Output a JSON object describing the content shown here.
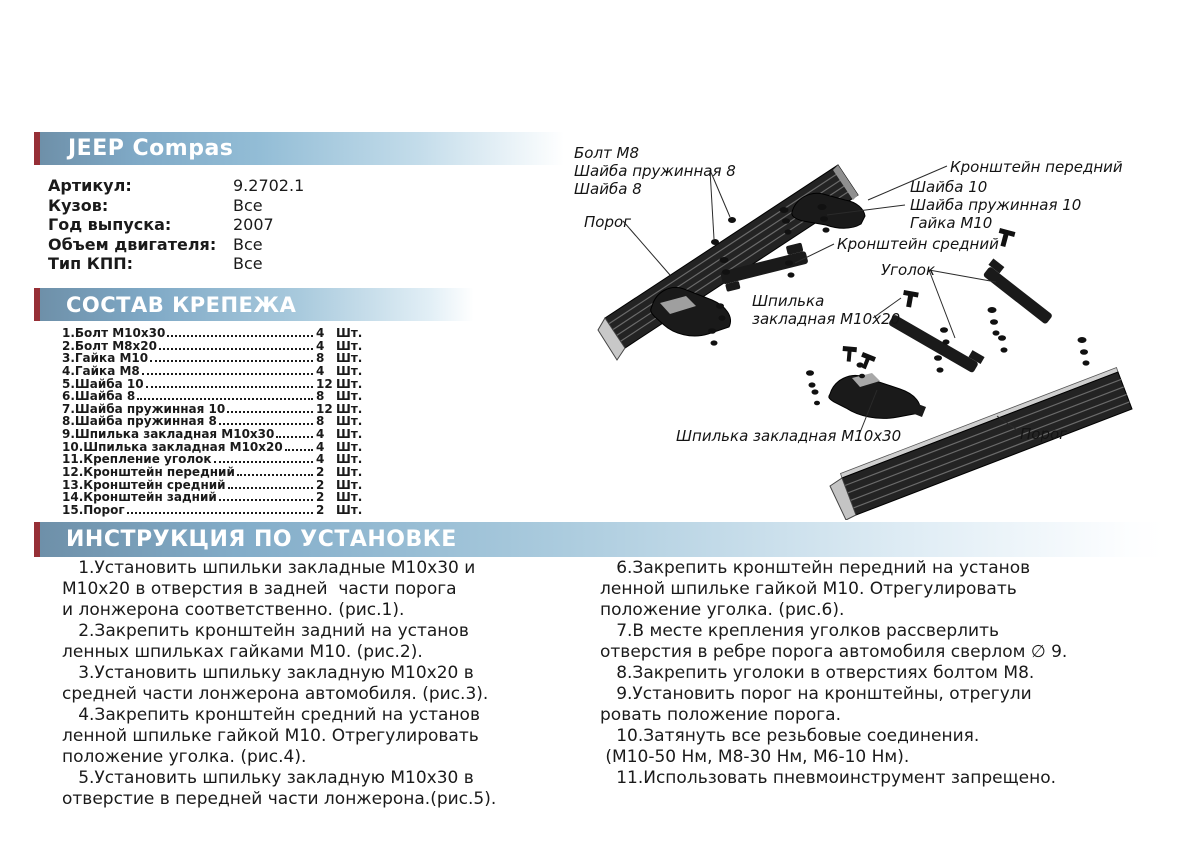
{
  "product": {
    "title": "JEEP Compas",
    "specs": [
      {
        "label": "Артикул:",
        "value": "9.2702.1"
      },
      {
        "label": "Кузов:",
        "value": "Все"
      },
      {
        "label": "Год выпуска:",
        "value": "2007"
      },
      {
        "label": "Объем двигателя:",
        "value": "Все"
      },
      {
        "label": "Тип КПП:",
        "value": "Все"
      }
    ]
  },
  "parts": {
    "header": "СОСТАВ КРЕПЕЖА",
    "unit": "Шт.",
    "items": [
      {
        "name": "1.Болт М10х30",
        "qty": "4"
      },
      {
        "name": "2.Болт М8х20",
        "qty": "4"
      },
      {
        "name": "3.Гайка М10",
        "qty": "8"
      },
      {
        "name": "4.Гайка М8",
        "qty": "4"
      },
      {
        "name": "5.Шайба 10",
        "qty": "12"
      },
      {
        "name": "6.Шайба 8",
        "qty": "8"
      },
      {
        "name": "7.Шайба пружинная 10",
        "qty": "12"
      },
      {
        "name": "8.Шайба пружинная 8",
        "qty": "8"
      },
      {
        "name": "9.Шпилька закладная М10х30",
        "qty": "4"
      },
      {
        "name": "10.Шпилька закладная М10х20",
        "qty": "4"
      },
      {
        "name": "11.Крепление уголок",
        "qty": "4"
      },
      {
        "name": "12.Кронштейн передний",
        "qty": "2"
      },
      {
        "name": "13.Кронштейн средний",
        "qty": "2"
      },
      {
        "name": "14.Кронштейн задний",
        "qty": "2"
      },
      {
        "name": "15.Порог",
        "qty": "2"
      }
    ]
  },
  "instructions": {
    "header": "ИНСТРУКЦИЯ ПО УСТАНОВКЕ",
    "left_lines": [
      "   1.Установить шпильки закладные М10х30 и",
      "М10х20 в отверстия в задней  части порога",
      "и лонжерона соответственно. (рис.1).",
      "   2.Закрепить кронштейн задний на установ",
      "ленных шпильках гайками М10. (рис.2).",
      "   3.Установить шпильку закладную М10х20 в",
      "средней части лонжерона автомобиля. (рис.3).",
      "   4.Закрепить кронштейн средний на установ",
      "ленной шпильке гайкой М10. Отрегулировать",
      "положение уголка. (рис.4).",
      "   5.Установить шпильку закладную М10х30 в",
      "отверстие в передней части лонжерона.(рис.5)."
    ],
    "right_lines": [
      "   6.Закрепить кронштейн передний на установ",
      "ленной шпильке гайкой М10. Отрегулировать",
      "положение уголка. (рис.6).",
      "   7.В месте крепления уголков рассверлить",
      "отверстия в ребре порога автомобиля сверлом ∅ 9.",
      "   8.Закрепить уголоки в отверстиях болтом М8.",
      "   9.Установить порог на кронштейны, отрегули",
      "ровать положение порога.",
      "   10.Затянуть все резьбовые соединения.",
      " (М10-50 Нм, М8-30 Нм, М6-10 Нм).",
      "   11.Использовать пневмоинструмент запрещено."
    ]
  },
  "diagram": {
    "labels": {
      "bolt_m8": "Болт М8",
      "washer_spring_8": "Шайба пружинная 8",
      "washer_8": "Шайба 8",
      "sill_left": "Порог",
      "bracket_front": "Кронштейн передний",
      "washer_10": "Шайба 10",
      "washer_spring_10": "Шайба пружинная 10",
      "nut_m10": "Гайка М10",
      "bracket_middle": "Кронштейн средний",
      "corner": "Уголок",
      "stud_line1": "Шпилька",
      "stud_line2": "закладная М10х20",
      "stud_m10x30": "Шпилька закладная М10х30",
      "sill_right": "Порог"
    }
  },
  "colors": {
    "band_blue_dark": "#6e90a9",
    "band_blue_light": "#c3dcea",
    "accent_red": "#962f36",
    "text": "#1a1a1a"
  }
}
